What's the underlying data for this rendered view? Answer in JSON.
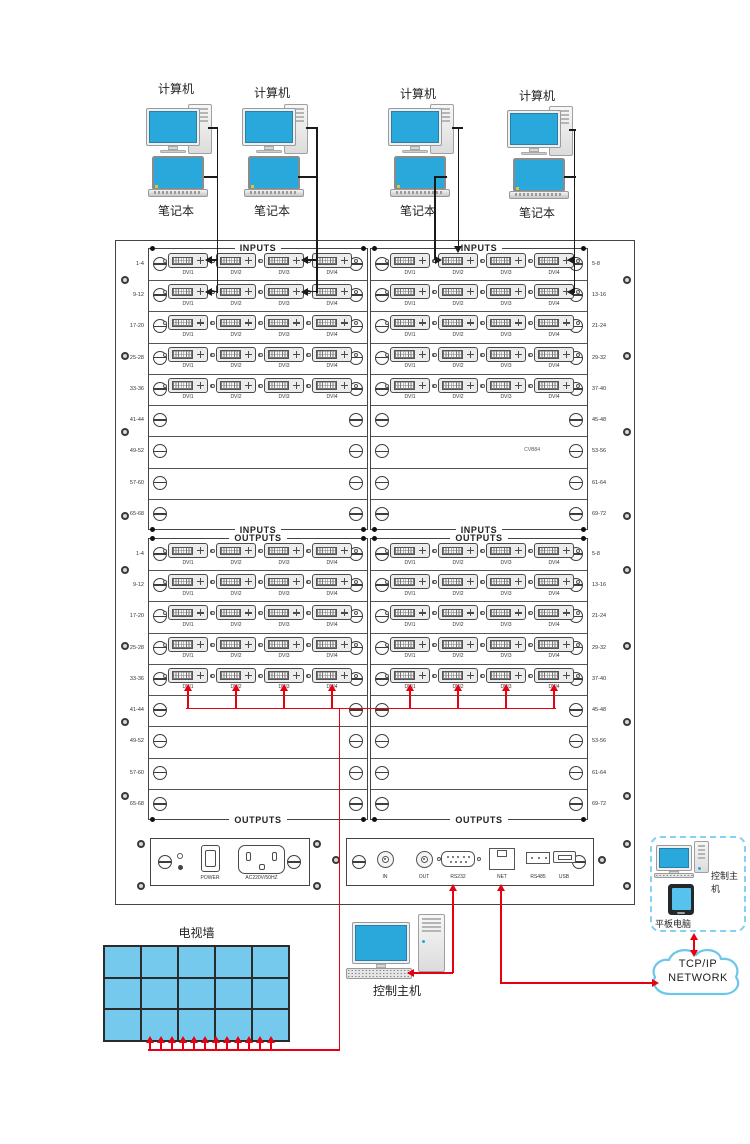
{
  "computers": {
    "groups": [
      {
        "computer_label": "计算机",
        "laptop_label": "笔记本"
      },
      {
        "computer_label": "计算机",
        "laptop_label": "笔记本"
      },
      {
        "computer_label": "计算机",
        "laptop_label": "笔记本"
      },
      {
        "computer_label": "计算机",
        "laptop_label": "笔记本"
      }
    ]
  },
  "chassis": {
    "slot_labels_left": [
      "1-4",
      "9-12",
      "17-20",
      "25-28",
      "33-36",
      "41-44",
      "49-52",
      "57-60",
      "65-68"
    ],
    "slot_labels_right": [
      "5-8",
      "13-16",
      "21-24",
      "29-32",
      "37-40",
      "45-48",
      "53-56",
      "61-64",
      "69-72"
    ],
    "inputs_section": {
      "title": "INPUTS",
      "watermark": "CVB84"
    },
    "outputs_section": {
      "title": "OUTPUTS"
    },
    "dvi_port_labels": [
      "DVI1",
      "DVI2",
      "DVI3",
      "DVI4"
    ],
    "card_rows_per_half": 5,
    "total_rows_per_half": 9,
    "power_module": {
      "switch_label": "POWER",
      "socket_label": "AC220V/50HZ"
    },
    "comm_module": {
      "port_labels": [
        "IN",
        "OUT",
        "RS232",
        "NET",
        "RS485",
        "USB"
      ]
    }
  },
  "tv_wall": {
    "label": "电视墙",
    "columns": 5,
    "rows": 3
  },
  "control_host": {
    "label": "控制主机"
  },
  "remote_control_box": {
    "host_label": "控制主机",
    "tablet_label": "平板电脑"
  },
  "network_cloud": {
    "line1": "TCP/IP",
    "line2": "NETWORK"
  },
  "colors": {
    "screen_blue": "#29A8DC",
    "tablet_screen_blue": "#57C2EE",
    "tv_wall_blue": "#74C9EC",
    "signal_red": "#E60012",
    "cable_black": "#1a1a1a",
    "cloud_stroke": "#6CC6E9"
  }
}
